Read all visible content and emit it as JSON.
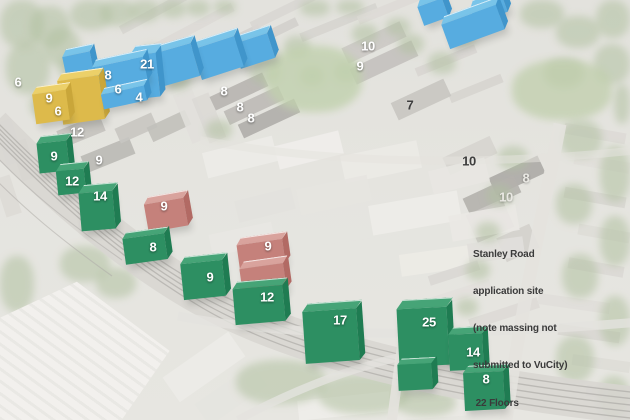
{
  "annotation": {
    "lines": [
      "Stanley Road",
      "application site",
      "(note massing not",
      "submitted to VuCity)",
      " 22 Floors"
    ]
  },
  "palette": {
    "green": {
      "top": "#46a477",
      "front": "#2d8f62",
      "side": "#1f7c52"
    },
    "red": {
      "top": "#d9a39d",
      "front": "#c5817b",
      "side": "#b26a64"
    },
    "yellow": {
      "top": "#ecd069",
      "front": "#ddba4b",
      "side": "#c9a63a"
    },
    "blue": {
      "top": "#79c4e9",
      "front": "#57ace0",
      "side": "#4095cb"
    }
  },
  "label_colors": {
    "white": "#ffffff",
    "dark": "#3d3d3d",
    "light": "#e9e8e3"
  },
  "buildings": [
    {
      "color": "blue",
      "x": 420,
      "y": 2,
      "w": 26,
      "h": 20,
      "rot": -20,
      "d": 7
    },
    {
      "color": "blue",
      "x": 472,
      "y": 2,
      "w": 34,
      "h": 16,
      "rot": -20,
      "d": 7
    },
    {
      "color": "blue",
      "x": 444,
      "y": 14,
      "w": 58,
      "h": 26,
      "rot": -20,
      "d": 7
    },
    {
      "color": "blue",
      "x": 236,
      "y": 38,
      "w": 36,
      "h": 26,
      "rot": -18,
      "d": 7
    },
    {
      "color": "blue",
      "x": 196,
      "y": 42,
      "w": 44,
      "h": 32,
      "rot": -18,
      "d": 7
    },
    {
      "color": "blue",
      "x": 156,
      "y": 48,
      "w": 40,
      "h": 34,
      "rot": -16,
      "d": 7
    },
    {
      "color": "blue",
      "x": 64,
      "y": 54,
      "w": 28,
      "h": 20,
      "rot": -12,
      "d": 7
    },
    {
      "color": "blue",
      "x": 132,
      "y": 54,
      "w": 26,
      "h": 44,
      "rot": -6,
      "d": 9
    },
    {
      "color": "blue",
      "x": 94,
      "y": 62,
      "w": 52,
      "h": 24,
      "rot": -12,
      "d": 7
    },
    {
      "color": "yellow",
      "x": 60,
      "y": 78,
      "w": 42,
      "h": 44,
      "rot": -8,
      "d": 7
    },
    {
      "color": "blue",
      "x": 102,
      "y": 90,
      "w": 44,
      "h": 15,
      "rot": -12,
      "d": 6
    },
    {
      "color": "yellow",
      "x": 34,
      "y": 92,
      "w": 34,
      "h": 30,
      "rot": -8,
      "d": 7
    },
    {
      "color": "green",
      "x": 38,
      "y": 142,
      "w": 30,
      "h": 30,
      "rot": -6,
      "d": 7
    },
    {
      "color": "green",
      "x": 57,
      "y": 170,
      "w": 28,
      "h": 24,
      "rot": -6,
      "d": 7
    },
    {
      "color": "green",
      "x": 80,
      "y": 192,
      "w": 34,
      "h": 38,
      "rot": -5,
      "d": 8
    },
    {
      "color": "red",
      "x": 146,
      "y": 201,
      "w": 40,
      "h": 28,
      "rot": -10,
      "d": 7
    },
    {
      "color": "green",
      "x": 124,
      "y": 236,
      "w": 42,
      "h": 26,
      "rot": -8,
      "d": 6
    },
    {
      "color": "red",
      "x": 238,
      "y": 242,
      "w": 46,
      "h": 24,
      "rot": -8,
      "d": 7
    },
    {
      "color": "green",
      "x": 182,
      "y": 262,
      "w": 42,
      "h": 36,
      "rot": -6,
      "d": 7
    },
    {
      "color": "red",
      "x": 241,
      "y": 266,
      "w": 44,
      "h": 26,
      "rot": -8,
      "d": 7
    },
    {
      "color": "green",
      "x": 234,
      "y": 287,
      "w": 50,
      "h": 36,
      "rot": -5,
      "d": 7
    },
    {
      "color": "green",
      "x": 398,
      "y": 308,
      "w": 50,
      "h": 58,
      "rot": -3,
      "d": 9
    },
    {
      "color": "green",
      "x": 304,
      "y": 310,
      "w": 54,
      "h": 52,
      "rot": -4,
      "d": 8
    },
    {
      "color": "green",
      "x": 449,
      "y": 334,
      "w": 34,
      "h": 36,
      "rot": -3,
      "d": 7
    },
    {
      "color": "green",
      "x": 398,
      "y": 364,
      "w": 34,
      "h": 26,
      "rot": -3,
      "d": 6
    },
    {
      "color": "green",
      "x": 464,
      "y": 372,
      "w": 40,
      "h": 38,
      "rot": -3,
      "d": 7
    }
  ],
  "floor_labels": [
    {
      "text": "6",
      "x": 18,
      "y": 82,
      "tone": "white"
    },
    {
      "text": "9",
      "x": 49,
      "y": 98,
      "tone": "white"
    },
    {
      "text": "6",
      "x": 58,
      "y": 111,
      "tone": "white"
    },
    {
      "text": "8",
      "x": 108,
      "y": 75,
      "tone": "white"
    },
    {
      "text": "6",
      "x": 118,
      "y": 89,
      "tone": "white"
    },
    {
      "text": "21",
      "x": 147,
      "y": 64,
      "tone": "white"
    },
    {
      "text": "4",
      "x": 139,
      "y": 97,
      "tone": "white"
    },
    {
      "text": "12",
      "x": 77,
      "y": 132,
      "tone": "white"
    },
    {
      "text": "9",
      "x": 99,
      "y": 160,
      "tone": "white"
    },
    {
      "text": "8",
      "x": 224,
      "y": 91,
      "tone": "white"
    },
    {
      "text": "8",
      "x": 240,
      "y": 107,
      "tone": "white"
    },
    {
      "text": "8",
      "x": 251,
      "y": 118,
      "tone": "white"
    },
    {
      "text": "10",
      "x": 368,
      "y": 46,
      "tone": "white"
    },
    {
      "text": "9",
      "x": 360,
      "y": 66,
      "tone": "white"
    },
    {
      "text": "7",
      "x": 410,
      "y": 105,
      "tone": "dark"
    },
    {
      "text": "10",
      "x": 469,
      "y": 161,
      "tone": "dark"
    },
    {
      "text": "8",
      "x": 526,
      "y": 178,
      "tone": "light"
    },
    {
      "text": "10",
      "x": 506,
      "y": 197,
      "tone": "light"
    },
    {
      "text": "9",
      "x": 54,
      "y": 156,
      "tone": "white"
    },
    {
      "text": "12",
      "x": 72,
      "y": 181,
      "tone": "white"
    },
    {
      "text": "14",
      "x": 100,
      "y": 196,
      "tone": "white"
    },
    {
      "text": "9",
      "x": 164,
      "y": 206,
      "tone": "white"
    },
    {
      "text": "8",
      "x": 153,
      "y": 247,
      "tone": "white"
    },
    {
      "text": "9",
      "x": 268,
      "y": 246,
      "tone": "white"
    },
    {
      "text": "9",
      "x": 210,
      "y": 277,
      "tone": "white"
    },
    {
      "text": "12",
      "x": 267,
      "y": 297,
      "tone": "white"
    },
    {
      "text": "17",
      "x": 340,
      "y": 320,
      "tone": "white"
    },
    {
      "text": "25",
      "x": 429,
      "y": 322,
      "tone": "white"
    },
    {
      "text": "14",
      "x": 473,
      "y": 352,
      "tone": "white"
    },
    {
      "text": "8",
      "x": 486,
      "y": 379,
      "tone": "white"
    }
  ]
}
